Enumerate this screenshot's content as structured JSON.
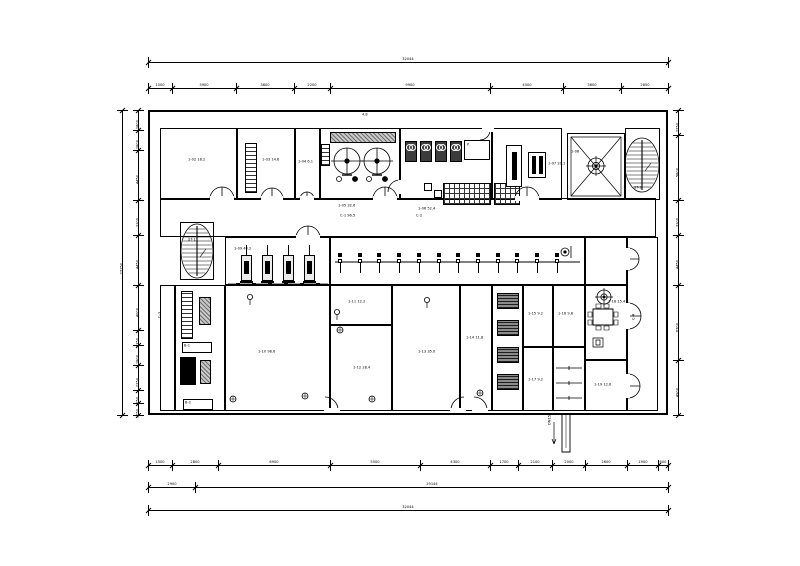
{
  "drawing": {
    "kind": "plant-floor-plan",
    "line_color": "#000000",
    "background": "#ffffff"
  },
  "dimensions": {
    "top_total": "32044",
    "top_segments": [
      "1500",
      "3900",
      "3600",
      "2200",
      "9900",
      "4500",
      "3600",
      "2850"
    ],
    "bottom_segments": [
      "1500",
      "2800",
      "6900",
      "5500",
      "4300",
      "1700",
      "2100",
      "2000",
      "2600",
      "1900",
      "600"
    ],
    "bottom_mid": [
      "2900",
      "29144"
    ],
    "bottom_total": "32044",
    "left_total": "27150",
    "left_segments": [
      "1800",
      "1800",
      "4450",
      "3100",
      "4450",
      "4000",
      "1350",
      "1800",
      "2250",
      "1150",
      "1050"
    ],
    "right_segments": [
      "2250",
      "5800",
      "3100",
      "4450",
      "6700",
      "4900"
    ]
  },
  "rooms": [
    "4.8",
    "1-02 18.2",
    "1-03 14.6",
    "1-04 6.1",
    "1-05 32.6",
    "1-06 52.4",
    "1-07 20.1",
    "1-08",
    "C-1 96.5",
    "C-2",
    "ST-1",
    "1-09 40.2",
    "1-10 98.6",
    "C-3",
    "1-11 12.2",
    "1-12 28.4",
    "1-13 35.0",
    "1-14 11.8",
    "1-15 9.2",
    "1-16 9.8",
    "1-17 9.2",
    "1-18 15.4",
    "1-19 12.6",
    "C-4",
    "B-1",
    "B-2",
    "DN150",
    "ST-2"
  ],
  "equipment": {
    "tanks": 2,
    "pumps": 4,
    "boilers": 4,
    "transformers": 4,
    "valves": 12,
    "panel_label": "P."
  }
}
